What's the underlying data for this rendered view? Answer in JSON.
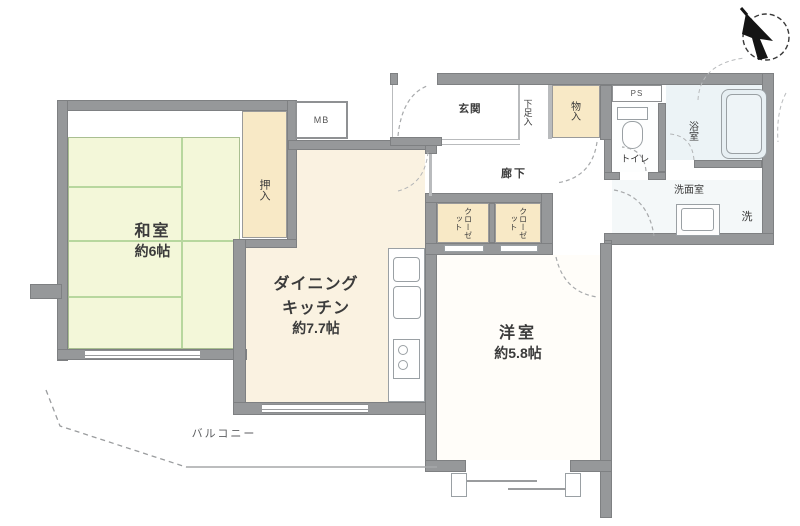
{
  "title": "floor-plan",
  "compass": {
    "direction": "north-west-arrow"
  },
  "rooms": {
    "washitsu": {
      "name": "和室",
      "size": "約6帖"
    },
    "dk": {
      "line1": "ダイニング",
      "line2": "キッチン",
      "size": "約7.7帖"
    },
    "yoshitsu": {
      "name": "洋室",
      "size": "約5.8帖"
    },
    "oshiire": "押入",
    "mb": "MB",
    "genkan": "玄関",
    "shoes": "下足入",
    "monoire": "物入",
    "hallway": "廊下",
    "ps": "PS",
    "toilet": "トイレ",
    "bath": "浴室",
    "washroom": "洗面室",
    "laundry": "洗",
    "closet": "クローゼット",
    "balcony": "バルコニー"
  },
  "colors": {
    "wall": "#96989a",
    "tatami": "#f3f7d9",
    "tatami_line": "#b7d79e",
    "storage_tan": "#f8e9c6",
    "dk_floor": "#faf2e1",
    "bath_floor": "#ecf3f6",
    "text": "#3b3b3b"
  }
}
